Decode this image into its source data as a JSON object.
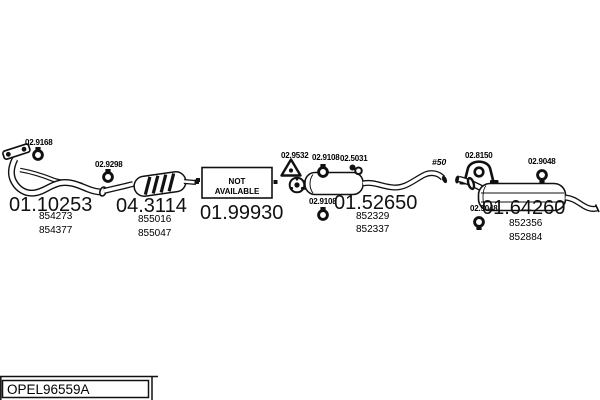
{
  "footer": {
    "catalog_code": "OPEL96559A"
  },
  "colors": {
    "ink": "#000000",
    "paper": "#ffffff"
  },
  "labels": {
    "front_clamp": "02.9168",
    "cat_clamp": "02.9298",
    "mid_hanger_front": "02.9532",
    "mid_clamp_top": "02.9108",
    "mid_hanger_rear": "02.5031",
    "mid_clamp_bottom": "02.9108",
    "diameter_note": "#50",
    "rear_mount": "02.8150",
    "rear_clamp_top": "02.9048",
    "rear_clamp_front": "02.9048"
  },
  "codes": {
    "front_pipe": "01.10253",
    "catalytic_converter": "04.3114",
    "center_pipe": "01.99930",
    "middle_muffler": "01.52650",
    "rear_muffler": "01.64260"
  },
  "oe_numbers": {
    "front_pipe": [
      "854273",
      "854377"
    ],
    "catalytic_converter": [
      "855016",
      "855047"
    ],
    "middle_muffler": [
      "852329",
      "852337"
    ],
    "rear_muffler": [
      "852356",
      "852884"
    ]
  },
  "not_available": {
    "line1": "NOT",
    "line2": "AVAILABLE"
  }
}
